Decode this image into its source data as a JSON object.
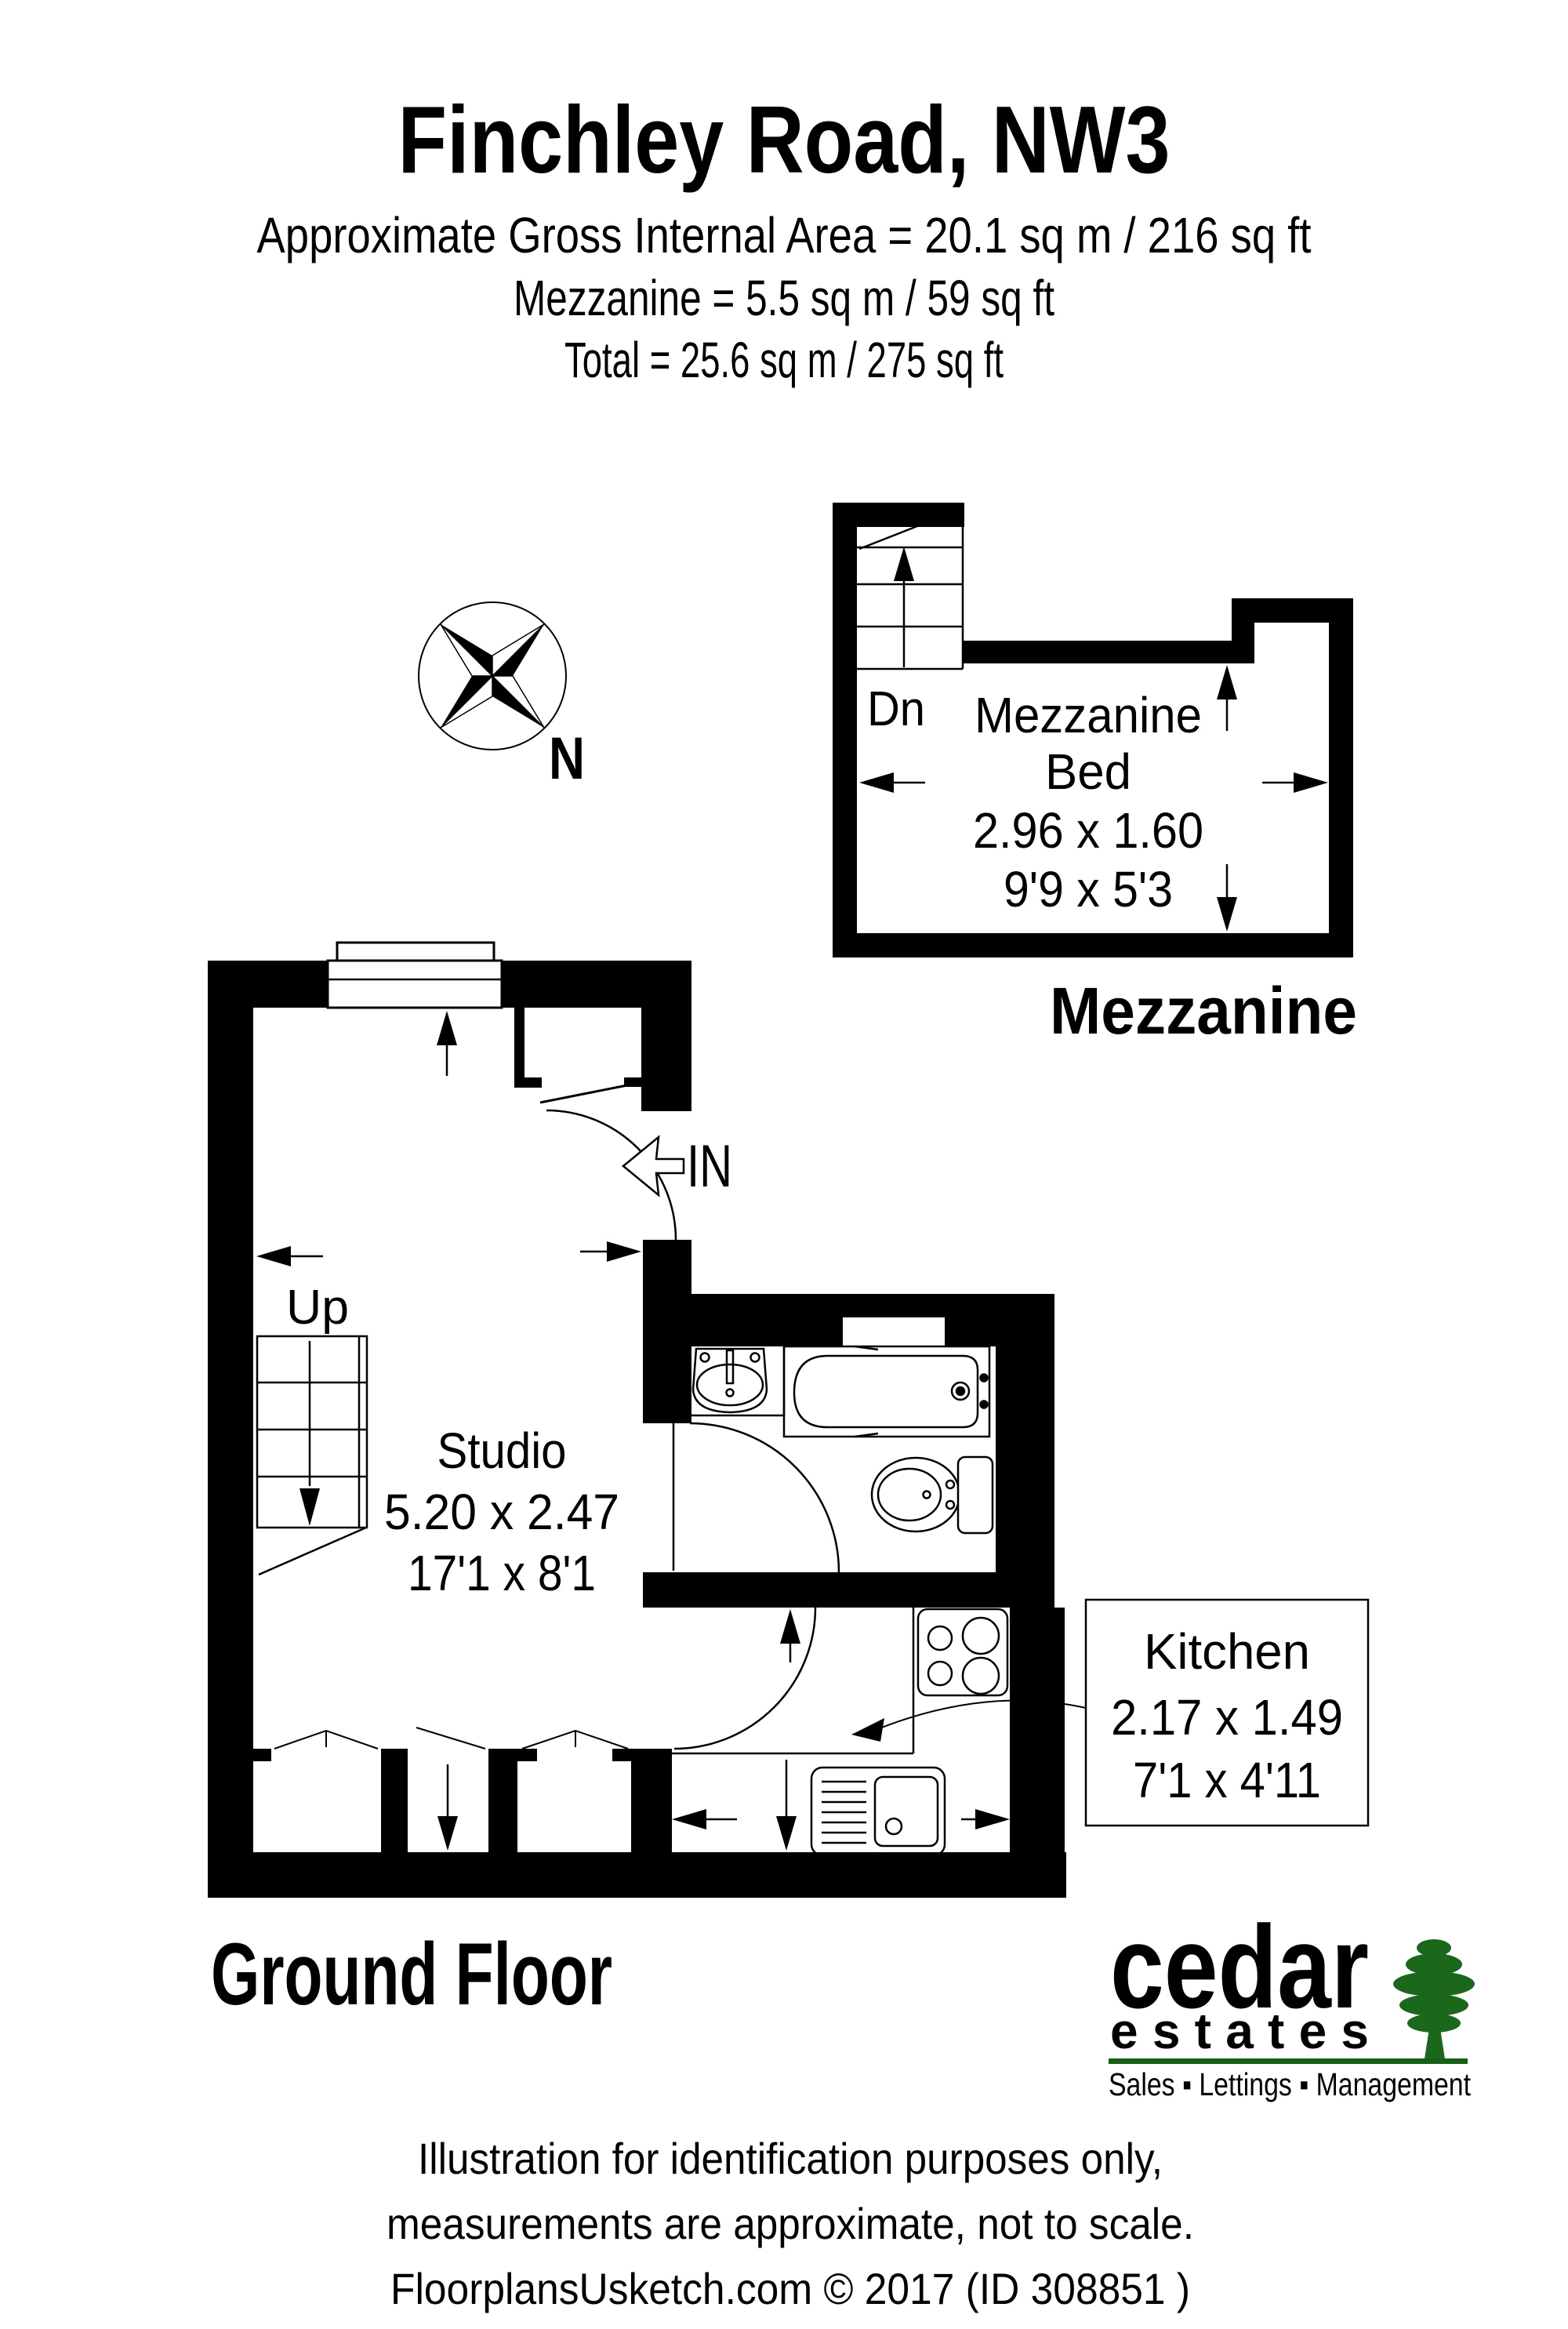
{
  "header": {
    "title": "Finchley Road, NW3",
    "area_line1": "Approximate Gross Internal Area = 20.1 sq m / 216 sq ft",
    "area_line2": "Mezzanine = 5.5 sq m / 59 sq ft",
    "area_line3": "Total = 25.6 sq m / 275 sq ft"
  },
  "compass": {
    "north_label": "N"
  },
  "mezzanine": {
    "floor_title": "Mezzanine",
    "stair_label": "Dn",
    "room_name_line1": "Mezzanine",
    "room_name_line2": "Bed",
    "dims_metric": "2.96 x 1.60",
    "dims_imperial": "9'9 x 5'3"
  },
  "ground_floor": {
    "floor_title": "Ground Floor",
    "stair_label": "Up",
    "entrance_label": "IN",
    "studio": {
      "name": "Studio",
      "dims_metric": "5.20 x 2.47",
      "dims_imperial": "17'1 x 8'1"
    },
    "kitchen": {
      "name": "Kitchen",
      "dims_metric": "2.17 x 1.49",
      "dims_imperial": "7'1 x 4'11"
    }
  },
  "logo": {
    "brand_line1": "cedar",
    "brand_line2": "estates",
    "tagline": "Sales ▪ Lettings ▪ Management",
    "brand_color": "#46262a",
    "tree_color": "#1b671b",
    "rule_color": "#166016"
  },
  "footer": {
    "line1": "Illustration for identification purposes only,",
    "line2": "measurements are approximate, not to scale.",
    "line3": "FloorplansUsketch.com © 2017 (ID 308851 )"
  },
  "colors": {
    "ink": "#000000",
    "paper": "#ffffff"
  }
}
